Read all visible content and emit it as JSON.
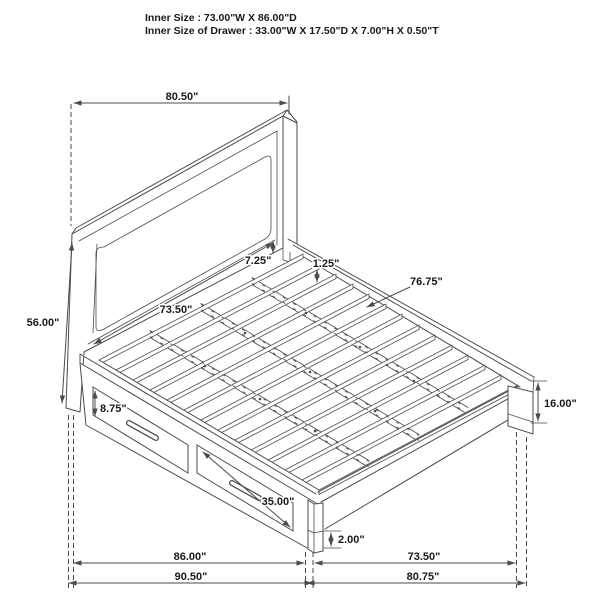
{
  "header": {
    "line1": "Inner Size : 73.00\"W X 86.00\"D",
    "line2": "Inner Size of Drawer : 33.00\"W X 17.50\"D X 7.00\"H X 0.50\"T"
  },
  "dimensions": {
    "headboard_width": "80.50\"",
    "headboard_height": "56.00\"",
    "headboard_panel_width": "73.50\"",
    "panel_to_slat_gap": "7.25\"",
    "slat_thickness": "1.25\"",
    "slat_platform_length": "76.75\"",
    "drawer_face_height": "8.75\"",
    "drawer_width": "35.00\"",
    "footboard_height": "16.00\"",
    "foot_leg_height": "2.00\"",
    "inner_depth": "86.00\"",
    "inner_width": "73.50\"",
    "overall_depth": "90.50\"",
    "overall_width": "80.75\""
  },
  "colors": {
    "line": "#4b4b4b",
    "text": "#1a1a1a",
    "background": "#ffffff"
  }
}
